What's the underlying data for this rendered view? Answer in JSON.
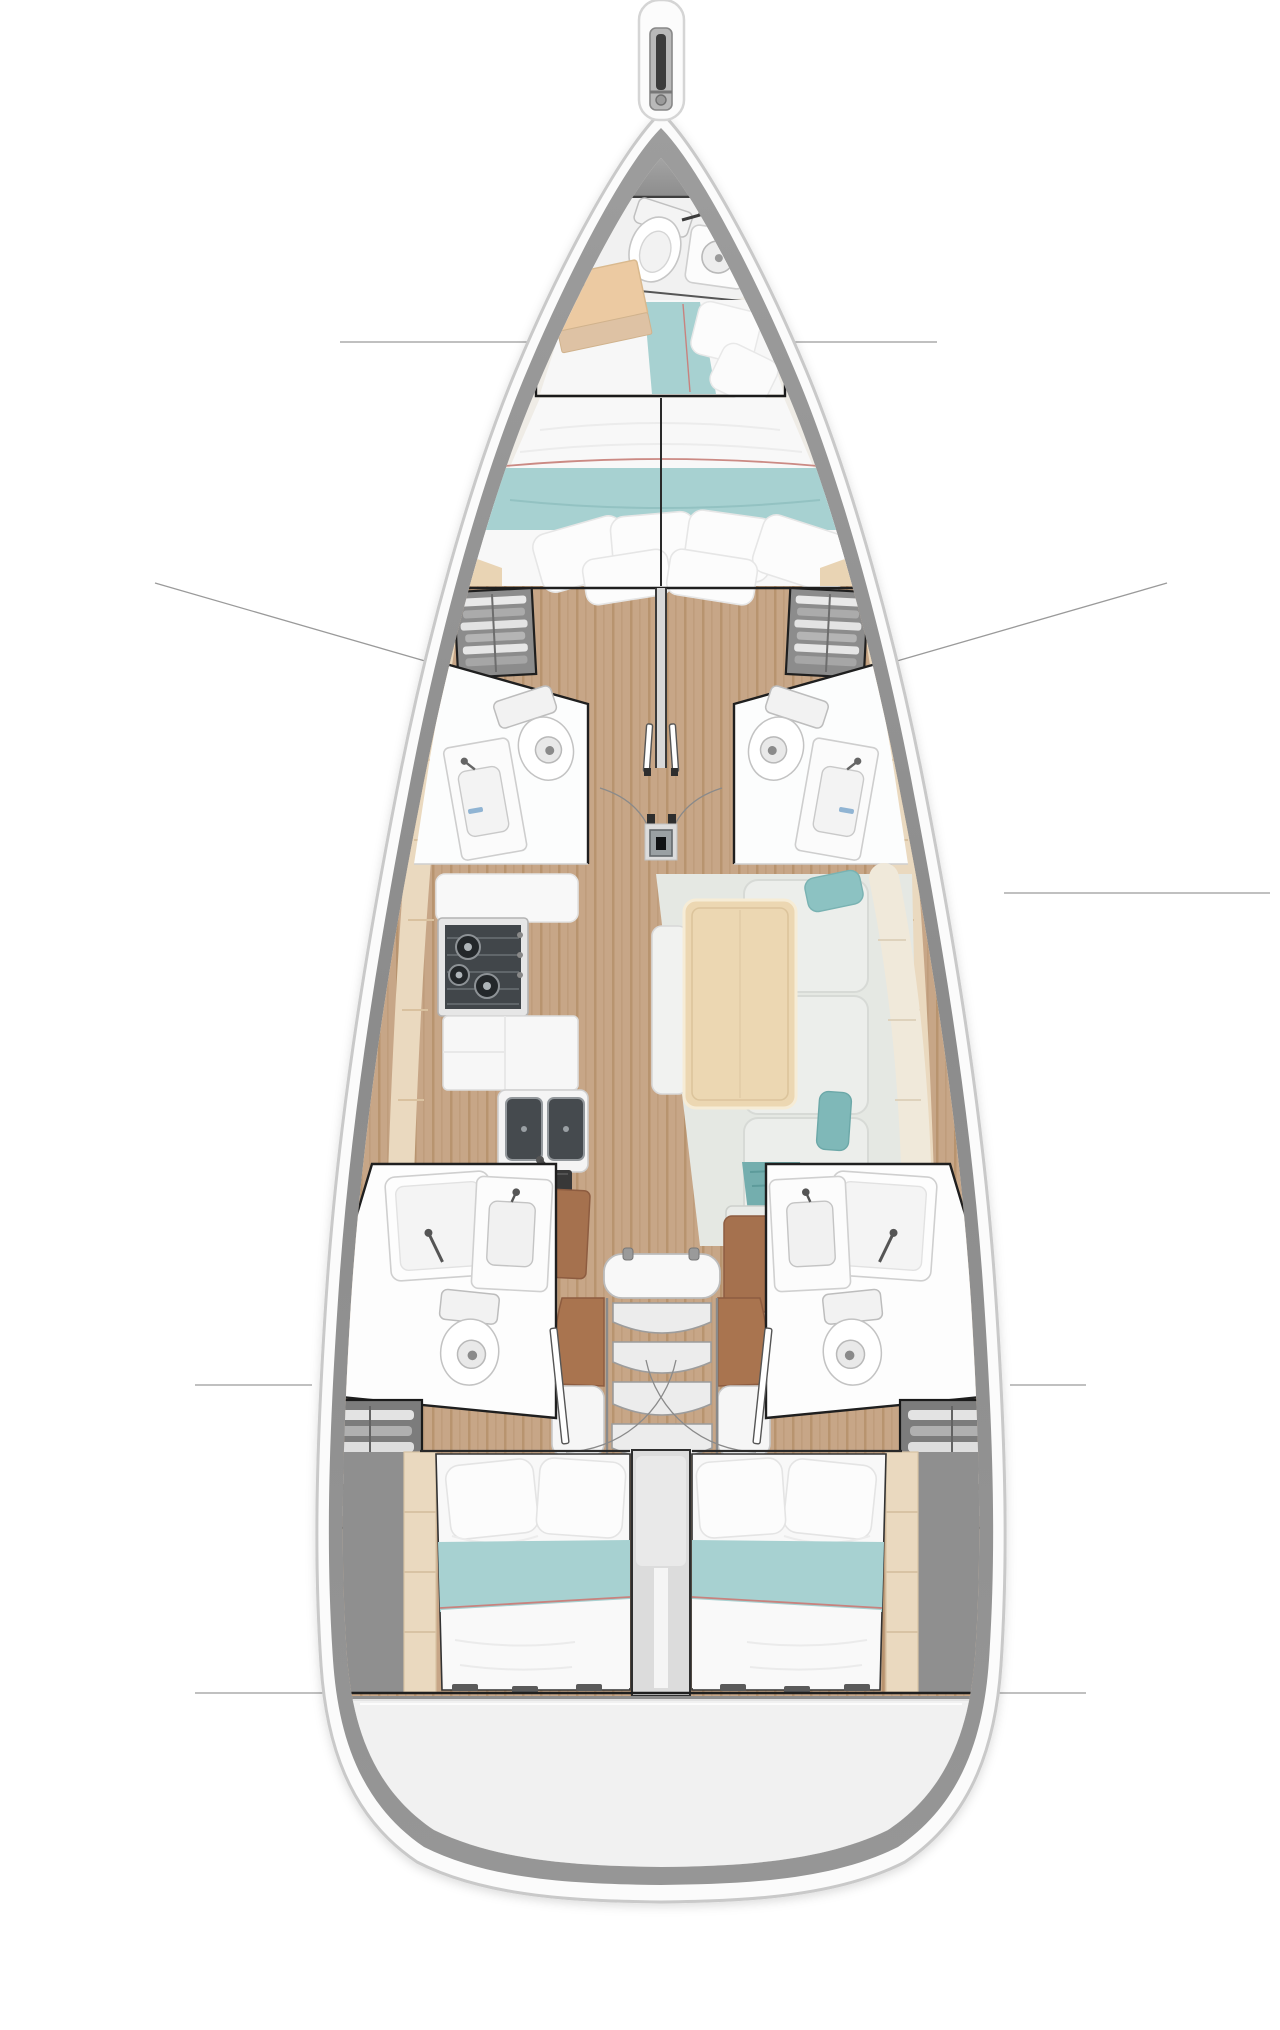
{
  "document": {
    "kind": "yacht-interior-floorplan",
    "view": "top-down deck plan, bow up, no visible text labels"
  },
  "palette": {
    "page_background": "#ffffff",
    "hull_shell": "#fbfbfb",
    "hull_edge": "#c9c9c9",
    "hull_band": "#909090",
    "foredeck_gray": "#a6a6a6",
    "interior_base": "#efece6",
    "floor_wood": "#c7a687",
    "floor_wood_dark": "#b5916f",
    "table_wood": "#ecd7b2",
    "cream_trim": "#ead9bf",
    "bedding_white": "#f8f8f8",
    "bedding_teal": "#a7d1d1",
    "piping_red": "#c8827e",
    "upholstery_gray": "#eceeeb",
    "pillow_teal": "#7fb8b8",
    "accent_wood_brown": "#a5714e",
    "appliance_dark": "#41464a",
    "outline_black": "#1a1a1a",
    "callout_line": "#9a9a9a",
    "stern_gray": "#f0f0f0"
  },
  "layout_summary": {
    "berth_areas": 4,
    "heads": 5,
    "has_galley": true,
    "has_salon_table": true,
    "companionway_steps": 4,
    "stove_burners": 3,
    "sink_basins": 2
  },
  "floorplan": {
    "vessel": {
      "type": "monohull sailing yacht",
      "orientation": "bow-up"
    },
    "areas": {
      "bowsprit": {
        "name": "Bowsprit with anchor roller"
      },
      "foredeck": {
        "name": "Foredeck"
      },
      "forward_head": {
        "name": "Forward head with toilet and shower"
      },
      "bow_cabin": {
        "name": "Bow crew cabin with single berth and locker"
      },
      "owner_cabin": {
        "name": "Forward owner cabin with double V-berth"
      },
      "wardrobe_port": {
        "name": "Port wardrobe shelving"
      },
      "wardrobe_starboard": {
        "name": "Starboard wardrobe shelving"
      },
      "head_mid_port": {
        "name": "Port midship head with toilet and washbasin"
      },
      "head_mid_starboard": {
        "name": "Starboard midship head with toilet and washbasin"
      },
      "mast": {
        "name": "Mast foot"
      },
      "galley": {
        "name": "Port galley with three-burner stove, counters and double sink"
      },
      "salon": {
        "name": "Starboard salon with dining table and L-shaped sofa"
      },
      "companionway": {
        "name": "Companionway with four steps and landing"
      },
      "head_aft_port": {
        "name": "Port aft head with shower, basin and toilet"
      },
      "head_aft_starboard": {
        "name": "Starboard aft head with shower, basin and toilet"
      },
      "locker_aft_port": {
        "name": "Port aft hanging locker"
      },
      "locker_aft_starboard": {
        "name": "Starboard aft hanging locker"
      },
      "cabin_aft_port": {
        "name": "Port aft cabin with double berth"
      },
      "cabin_aft_starboard": {
        "name": "Starboard aft cabin with double berth"
      },
      "stern_locker": {
        "name": "Stern lazarette / transom"
      }
    },
    "fixtures": [
      {
        "area": "forward_head",
        "items": [
          "toilet",
          "shower-pan-with-drain"
        ]
      },
      {
        "area": "bow_cabin",
        "items": [
          "single-berth-teal-runner",
          "wood-locker",
          "pillows"
        ]
      },
      {
        "area": "owner_cabin",
        "items": [
          "v-berth",
          "four-pillows",
          "teal-runner",
          "red-piping",
          "center-split-line"
        ]
      },
      {
        "area": "head_mid_port",
        "items": [
          "toilet",
          "washbasin-counter",
          "door-swing-arc"
        ]
      },
      {
        "area": "head_mid_starboard",
        "items": [
          "toilet",
          "washbasin-counter",
          "door-swing-arc"
        ]
      },
      {
        "area": "galley",
        "items": [
          "worktop",
          "three-burner-stove",
          "lower-cabinet",
          "double-sink",
          "dark-counter",
          "nav-desk"
        ]
      },
      {
        "area": "salon",
        "items": [
          "dining-table",
          "l-shaped-sofa",
          "teal-cushions",
          "inboard-bench",
          "teal-throw",
          "wood-grate-step",
          "brown-seat"
        ]
      },
      {
        "area": "companionway",
        "items": [
          "entry-sill",
          "four-steps",
          "handrails",
          "landing",
          "center-divider"
        ]
      },
      {
        "area": "head_aft_port",
        "items": [
          "shower-pan",
          "washbasin",
          "toilet",
          "door-swing-arc"
        ]
      },
      {
        "area": "head_aft_starboard",
        "items": [
          "shower-pan",
          "washbasin",
          "toilet",
          "door-swing-arc"
        ]
      },
      {
        "area": "cabin_aft_port",
        "items": [
          "double-berth",
          "two-pillows",
          "teal-runner",
          "red-piping",
          "cream-side-trim"
        ]
      },
      {
        "area": "cabin_aft_starboard",
        "items": [
          "double-berth",
          "two-pillows",
          "teal-runner",
          "red-piping",
          "cream-side-trim"
        ]
      }
    ],
    "callouts": [
      {
        "side": "port",
        "points_to": "bow_cabin"
      },
      {
        "side": "starboard",
        "points_to": "bow_cabin"
      },
      {
        "side": "port",
        "points_to": "wardrobe_port"
      },
      {
        "side": "starboard",
        "points_to": "wardrobe_starboard"
      },
      {
        "side": "starboard",
        "points_to": "salon"
      },
      {
        "side": "port",
        "points_to": "locker_aft_port"
      },
      {
        "side": "starboard",
        "points_to": "locker_aft_starboard"
      },
      {
        "side": "both",
        "points_to": "aft-cabin-bulkhead"
      }
    ]
  }
}
